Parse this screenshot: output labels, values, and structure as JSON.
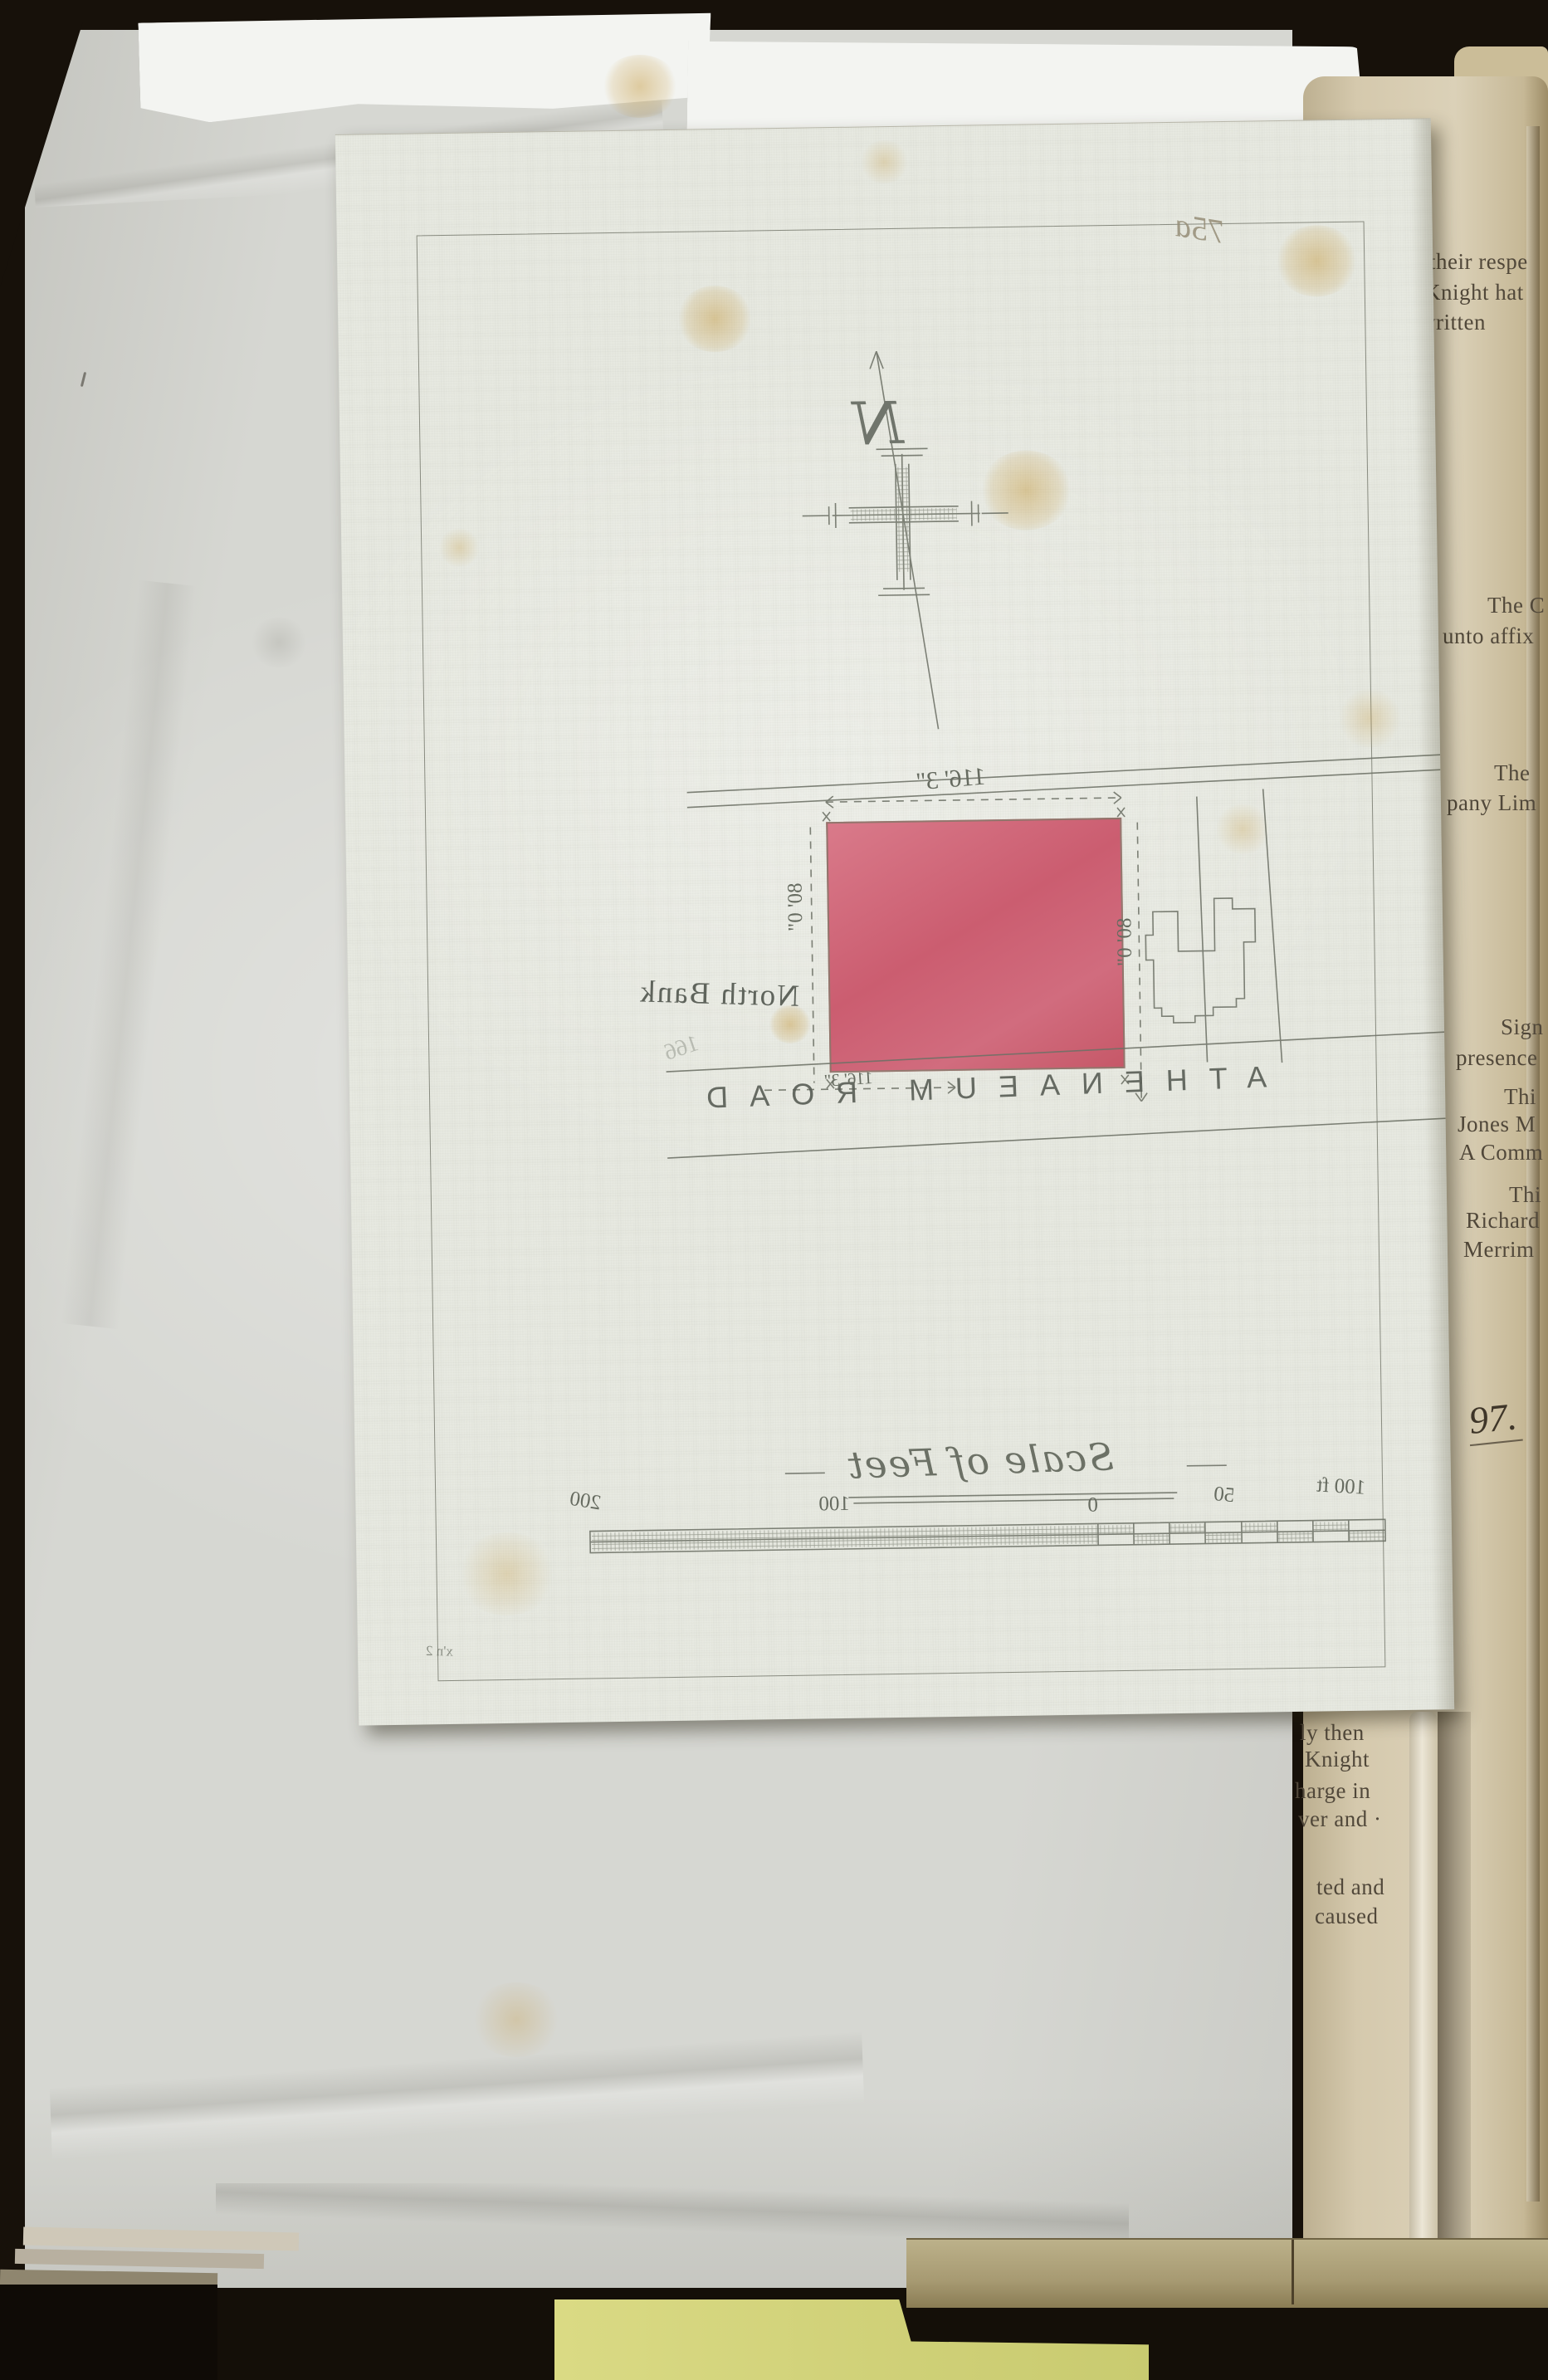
{
  "book_page": {
    "upper_fragments": [
      "their respe",
      "Knight hat",
      "written",
      "The C",
      "unto affix",
      "The",
      "pany Lim",
      "Sign",
      "presence",
      "Thi",
      "Jones M",
      "A Comm",
      "Thi",
      "Richard",
      "Merrim"
    ],
    "handwritten_number": "97.",
    "lower_fragments": [
      "ly then",
      "Knight",
      "harge in",
      "ver and ·",
      "ted and",
      "caused"
    ]
  },
  "plan": {
    "sheet_annotation": "75a",
    "compass_letter": "N",
    "labels": {
      "north_bank": "North Bank",
      "faint_number": "166",
      "road": "ATHENAEUM ROAD",
      "dim_top": "116' 3\"",
      "dim_bottom": "116' 3\"",
      "dim_left": "80' 0\"",
      "dim_right": "80' 0\"",
      "scale_title": "Scale of Feet",
      "surveyor_initials": "x'n 2"
    },
    "scale_ticks": [
      "200",
      "100",
      "0",
      "50",
      "100 ft"
    ],
    "plot_color": "#d0677a"
  },
  "colors": {
    "background": "#17110a",
    "backing_paper": "#d6d7d2",
    "torn_paper": "#f3f4f1",
    "book_page": "#d5c9ad",
    "plan_sheet": "#e7e9e1",
    "plot_red": "#d0677a",
    "note_yellow": "#d5d57d",
    "pencil": "#6d7166"
  }
}
